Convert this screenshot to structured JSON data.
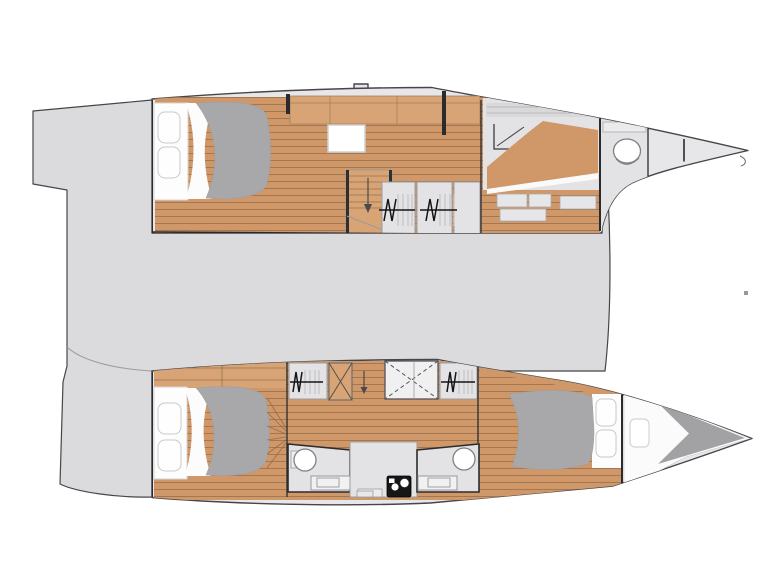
{
  "colors": {
    "background": "#ffffff",
    "deck": "#dbdbdd",
    "hull": "#e7e7e9",
    "room_floor": "#e3e3e5",
    "wood": "#d09768",
    "wood_light": "#d8a476",
    "plank_line": "#8a6847",
    "duvet": "#a8a8aa",
    "pillow": "#fefefe",
    "pillow_border": "#c9c9cb",
    "outline": "#46464a",
    "wall": "#2b2b2e",
    "line_mid": "#9a9a9d",
    "fixture": "#808083",
    "black_unit": "#161616",
    "dashed_x": "#55555a",
    "forepeak_white": "#fbfbfc",
    "bow_wedge": "#a2a2a4"
  },
  "plan": {
    "hulls": [
      "top-hull",
      "bottom-hull"
    ],
    "symbols": [
      "double-bed",
      "pillow",
      "duvet",
      "hanging-locker",
      "staircase",
      "stair-arrow",
      "roof-hatch",
      "toilet",
      "washbasin",
      "shower-tray",
      "stove",
      "bow-bulkhead",
      "chart-desk",
      "sofa"
    ]
  }
}
